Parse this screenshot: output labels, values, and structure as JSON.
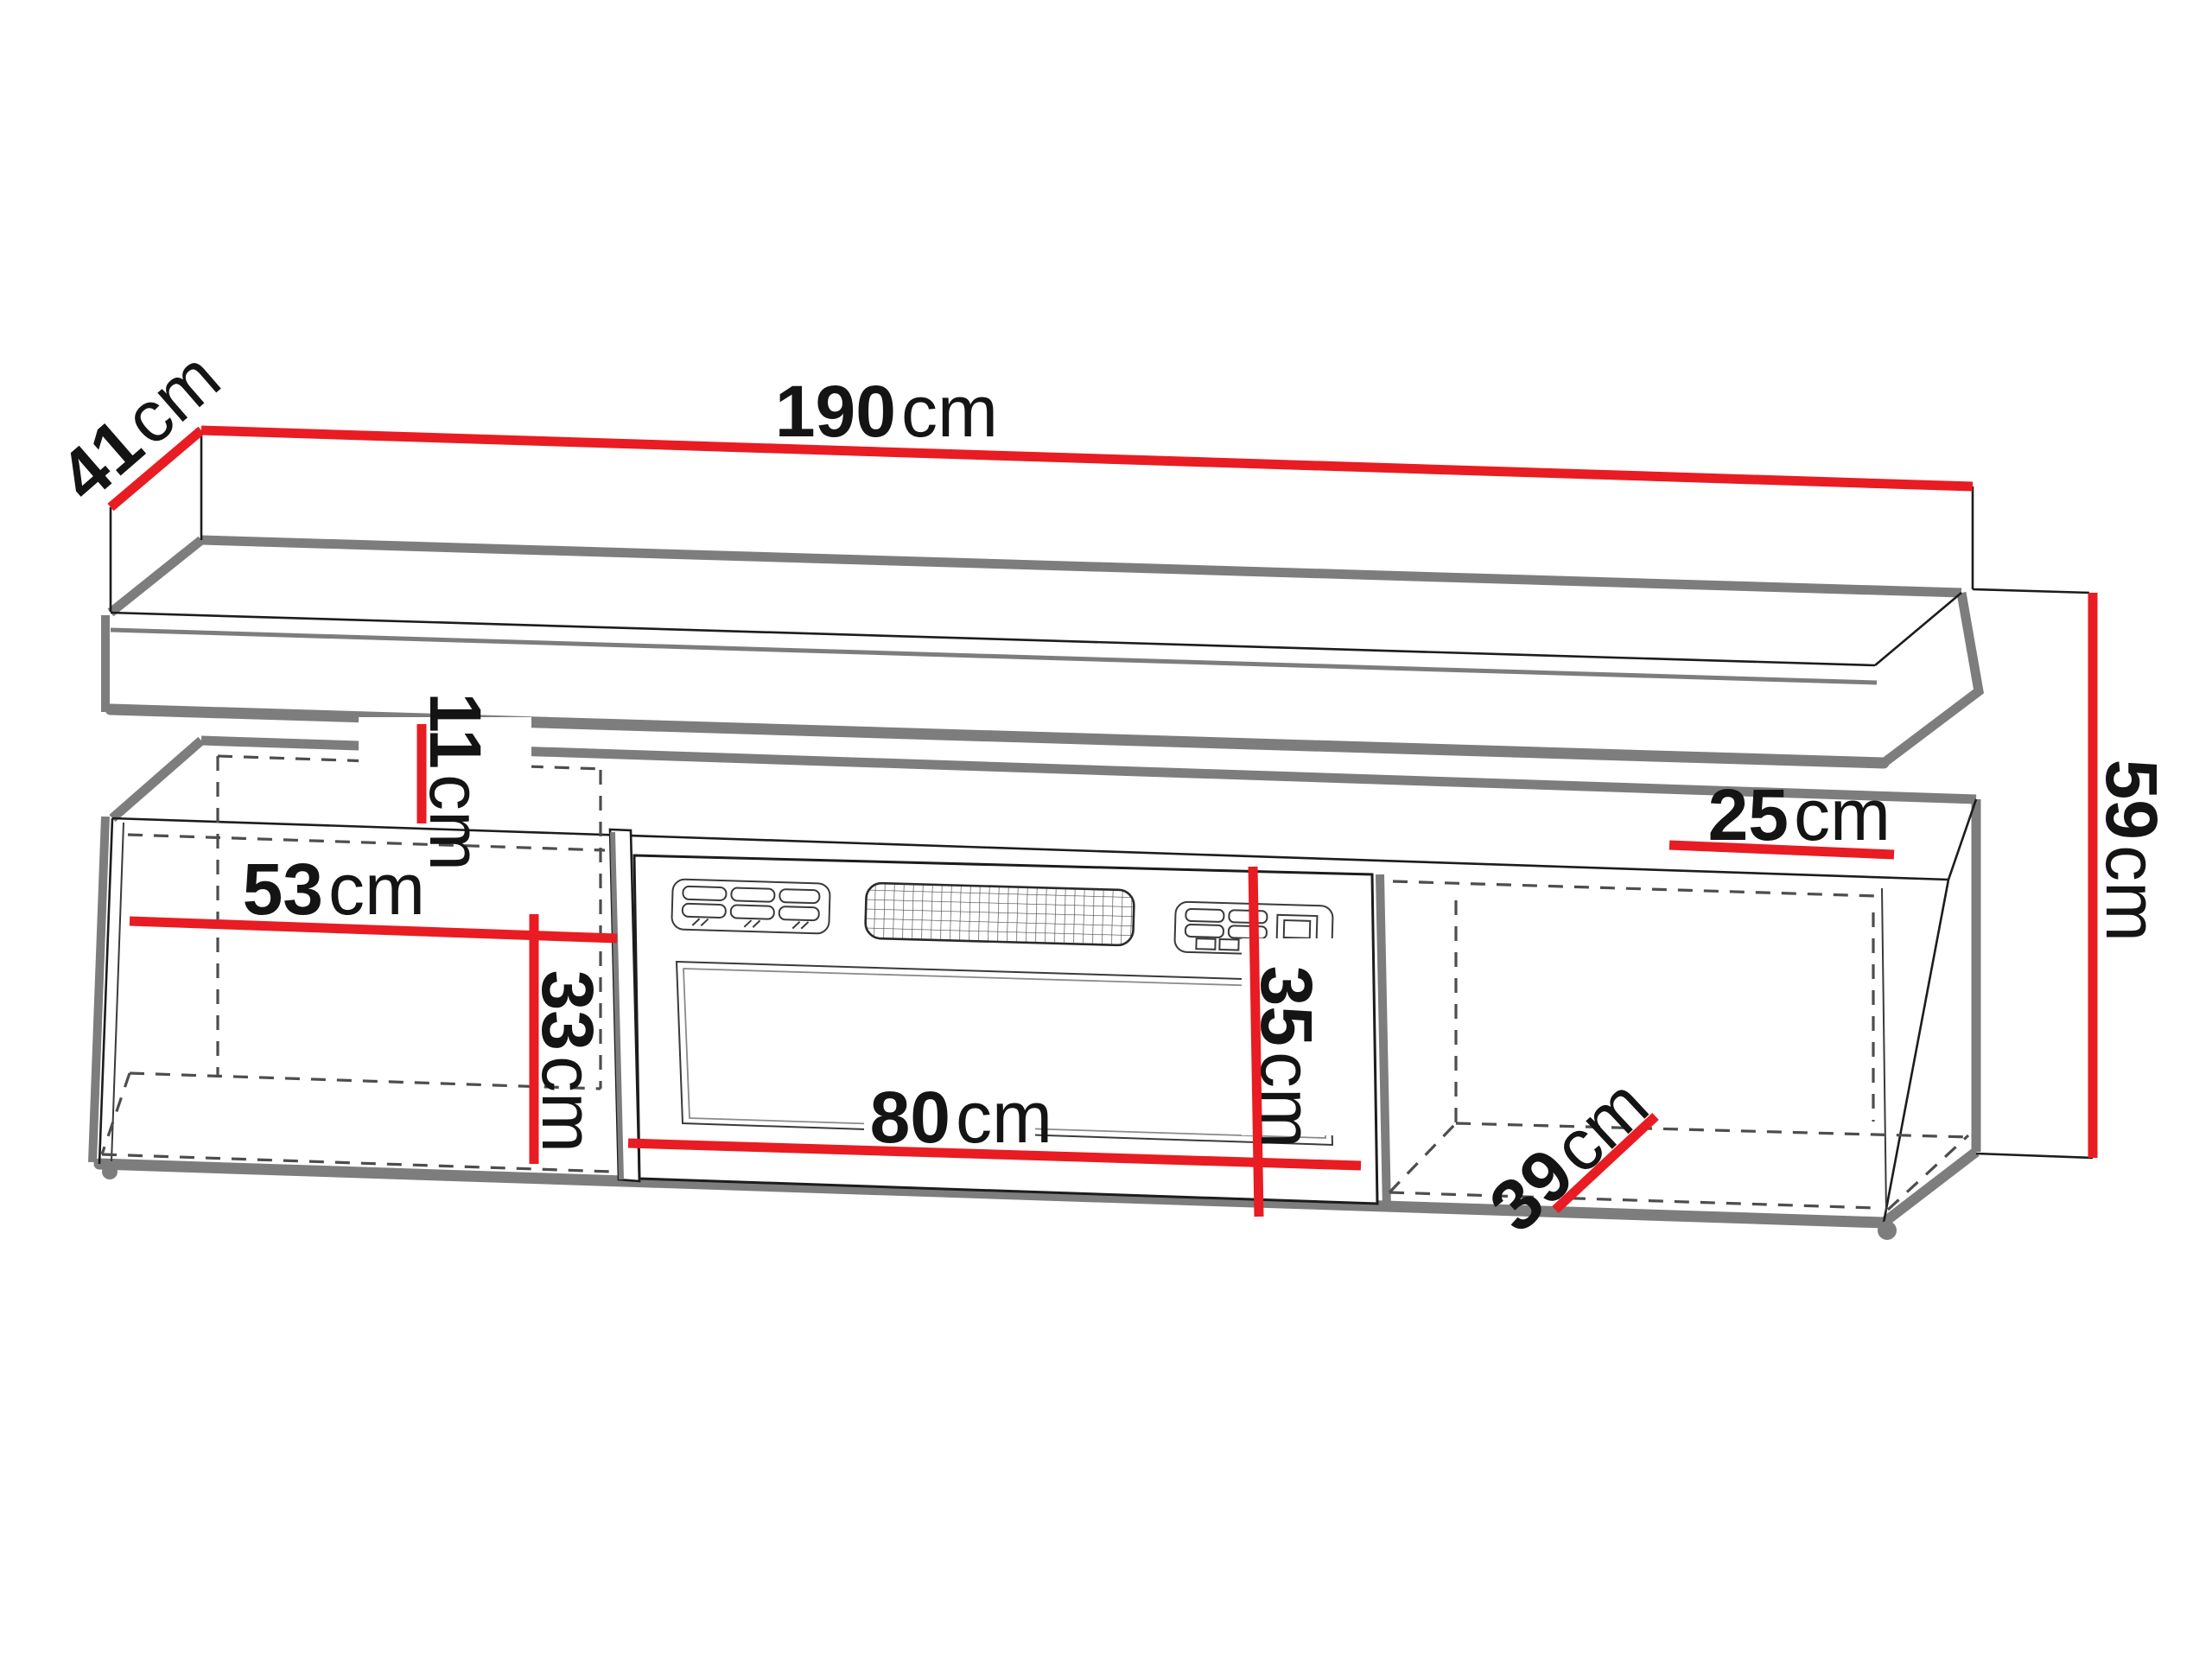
{
  "diagram": {
    "type": "furniture-dimension-diagram",
    "subject": "tv-stand-with-fireplace-and-wall-shelf",
    "unit": "cm",
    "colors": {
      "dimension_line": "#e81c22",
      "outline": "#1c1c1c",
      "shadow": "#7d7d7d",
      "hidden_edge": "#4d4d4d",
      "background": "#ffffff"
    },
    "dimensions": {
      "shelf_width": {
        "value": "190",
        "unit": "cm"
      },
      "shelf_depth": {
        "value": "41",
        "unit": "cm"
      },
      "total_height": {
        "value": "59",
        "unit": "cm"
      },
      "top_depth": {
        "value": "25",
        "unit": "cm"
      },
      "shelf_gap": {
        "value": "11",
        "unit": "cm"
      },
      "left_compartment_width": {
        "value": "53",
        "unit": "cm"
      },
      "left_compartment_height": {
        "value": "33",
        "unit": "cm"
      },
      "fireplace_width": {
        "value": "80",
        "unit": "cm"
      },
      "fireplace_height": {
        "value": "35",
        "unit": "cm"
      },
      "right_compartment_depth": {
        "value": "39",
        "unit": "cm"
      }
    }
  }
}
